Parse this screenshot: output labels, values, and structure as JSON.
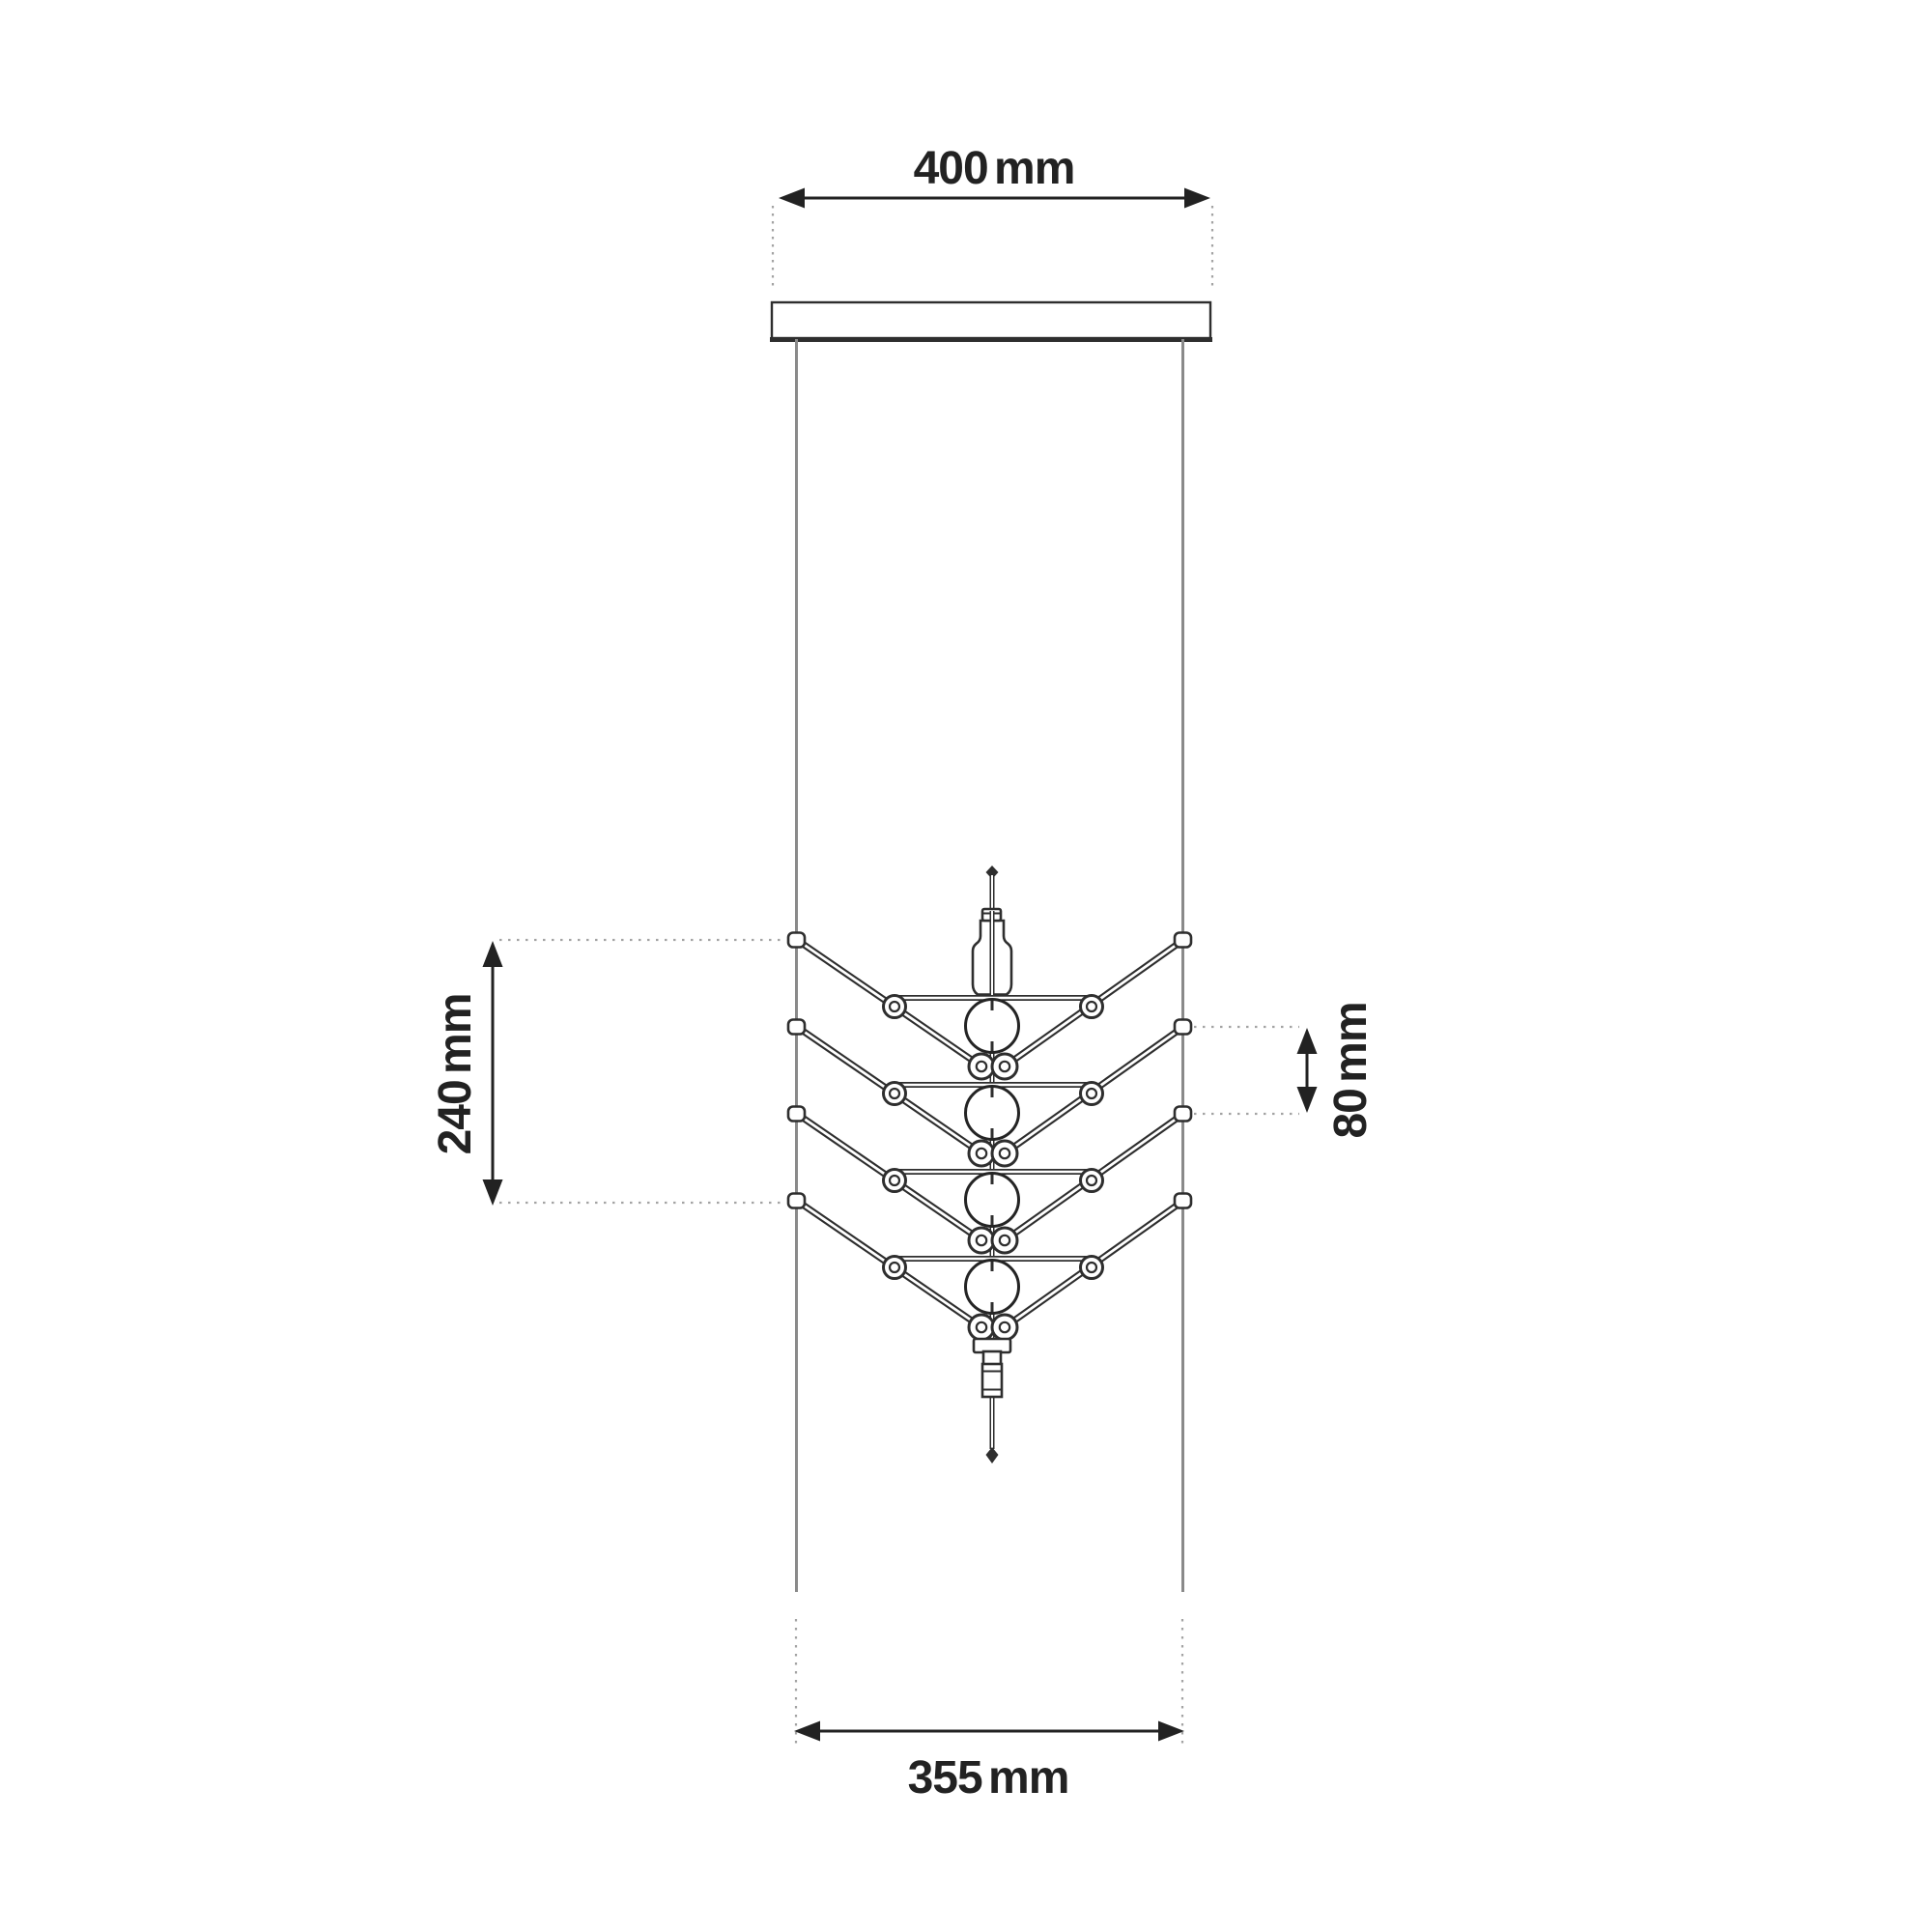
{
  "colors": {
    "background": "#ffffff",
    "ink": "#222222",
    "fixture": "#2e2e2e",
    "cable": "#8a8a8a",
    "leader": "#a3a3a3"
  },
  "figure": {
    "type": "technical-dimension-elevation",
    "tier_count": 4,
    "bulb_count": 4,
    "suspension_cable_count": 2
  },
  "icons": {
    "dimension_arrowhead": "filled-triangle"
  },
  "drawing": {
    "dimensions": {
      "top_width": {
        "label": "400 mm",
        "value": 400,
        "unit": "mm",
        "orientation": "horizontal",
        "location": "top"
      },
      "left_span": {
        "label": "240 mm",
        "value": 240,
        "unit": "mm",
        "orientation": "vertical",
        "location": "left"
      },
      "right_spacing": {
        "label": "80 mm",
        "value": 80,
        "unit": "mm",
        "orientation": "vertical",
        "location": "right"
      },
      "bottom_width": {
        "label": "355 mm",
        "value": 355,
        "unit": "mm",
        "orientation": "horizontal",
        "location": "bottom"
      }
    }
  }
}
